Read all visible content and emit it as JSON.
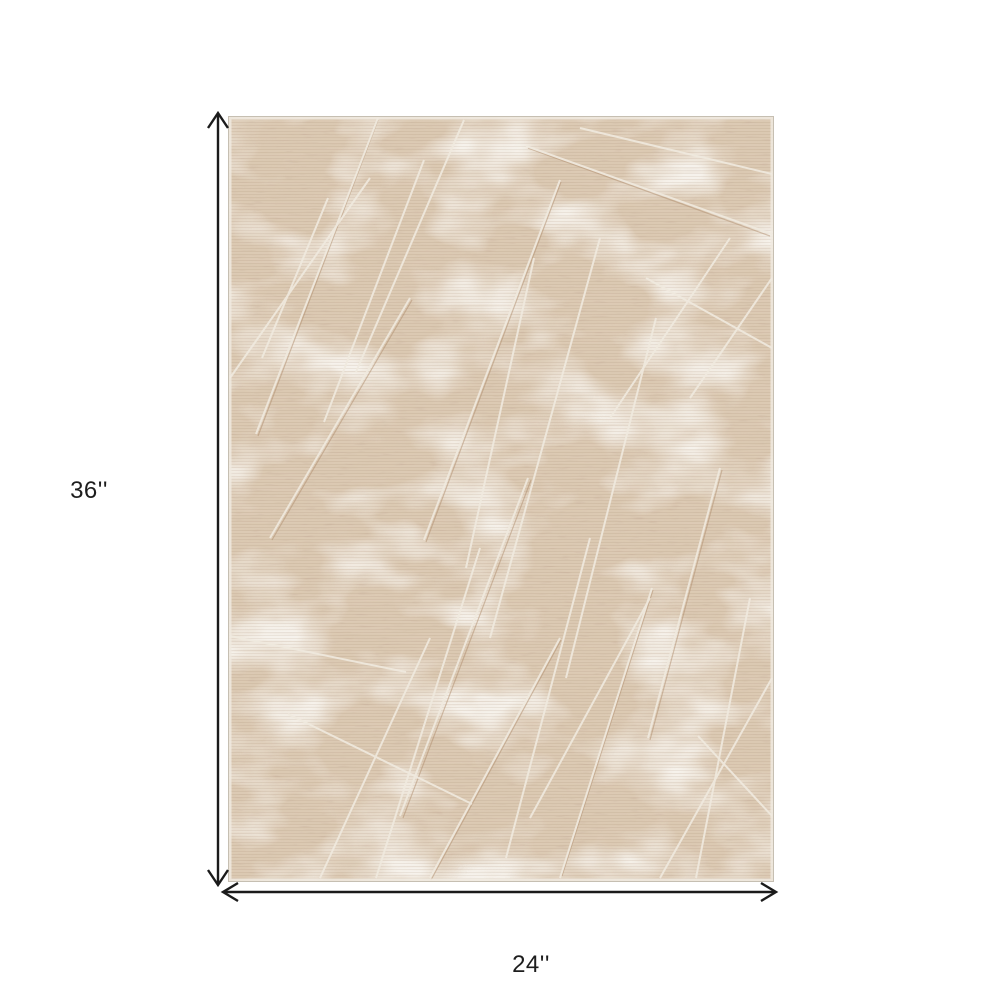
{
  "diagram": {
    "kind": "product-dimensions",
    "background_color": "#ffffff",
    "arrow_color": "#1b1b1b",
    "label_color": "#1d1d1d",
    "height_dimension": {
      "label": "36''",
      "inches": 36
    },
    "width_dimension": {
      "label": "24''",
      "inches": 24
    }
  },
  "rug": {
    "description": "Beige and ivory distressed abstract rectangular area rug photo, shown 24 inches wide by 36 inches tall",
    "palette": {
      "base": "#dbc9b2",
      "tan_striation": "#ba9978",
      "dark_fleck": "#96735a",
      "cream_patch": "#efe9df",
      "scratch_line": "#f0eadf",
      "edge_trim": "#c6bfb2"
    }
  }
}
